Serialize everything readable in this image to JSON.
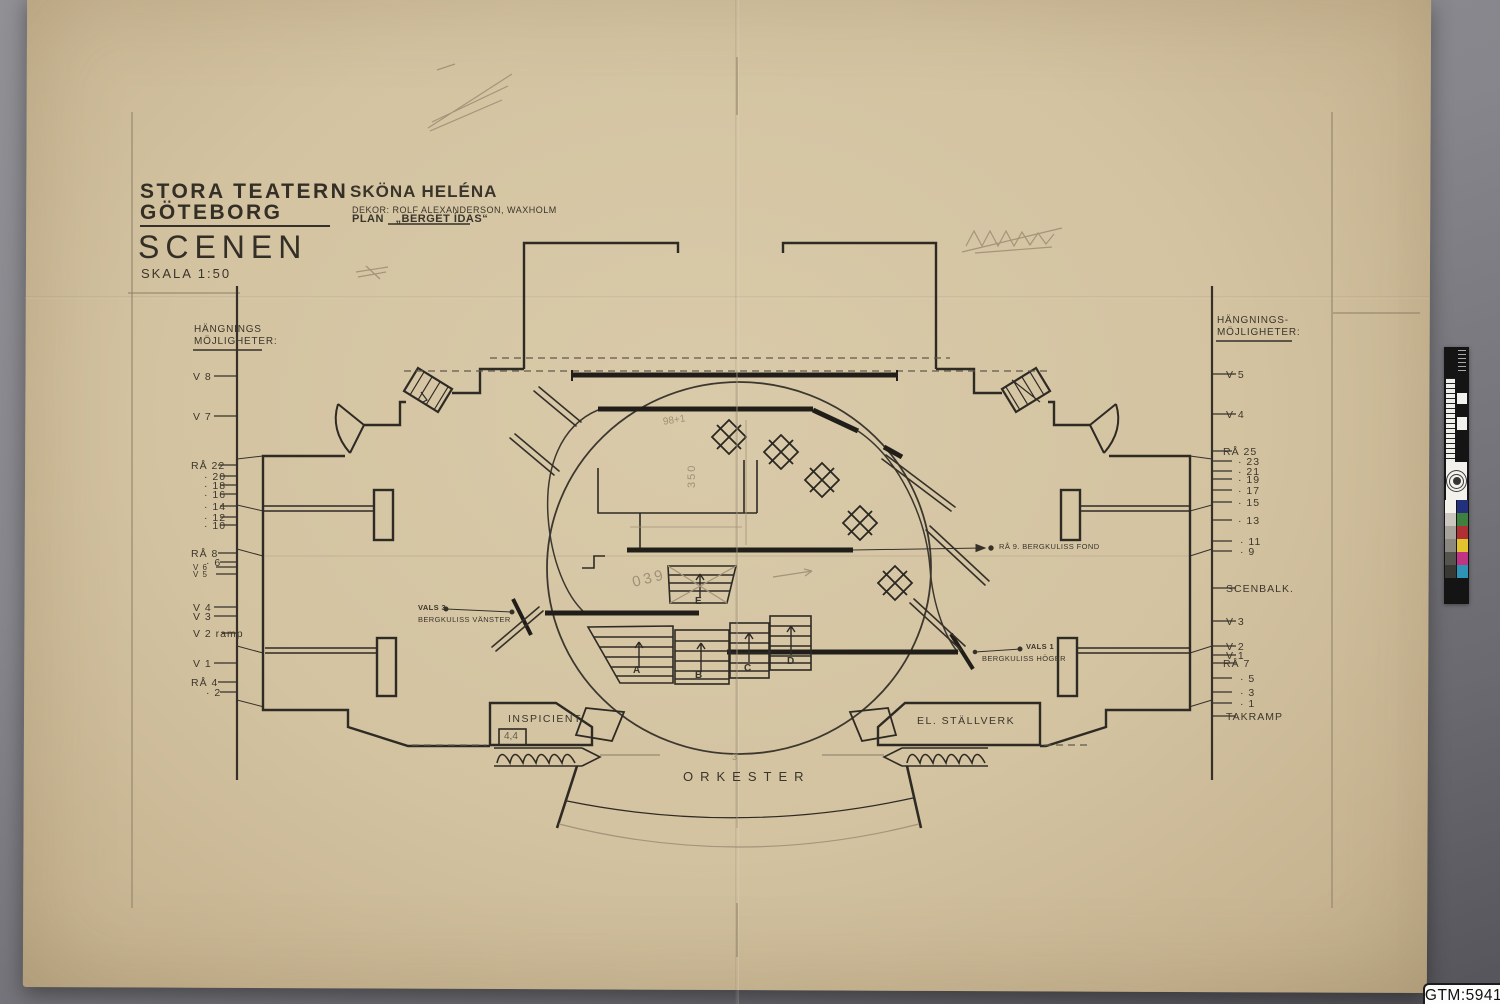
{
  "drawing": {
    "title_block": {
      "name1": "STORA TEATERN",
      "name2": "GÖTEBORG",
      "sheet": "SCENEN",
      "scale": "SKALA 1:50"
    },
    "production": {
      "title": "SKÖNA HELÉNA",
      "decor": "DEKOR: ROLF ALEXANDERSON, WAXHOLM",
      "plan_label": "PLAN",
      "plan_name": "„BERGET ÍDAS“"
    },
    "left_rigging": {
      "header1": "HÄNGNINGS",
      "header2": "MÖJLIGHETER:",
      "items": [
        "V 8",
        "V 7",
        "RÅ 22",
        "· 20",
        "· 18",
        "· 16",
        "· 14",
        "· 12",
        "· 10",
        "RÅ 8",
        "· 6",
        "V 6",
        "V 5",
        "V 4",
        "V 3",
        "V 2 ramp",
        "V 1",
        "RÅ 4",
        "· 2"
      ]
    },
    "right_rigging": {
      "header1": "HÄNGNINGS-",
      "header2": "MÖJLIGHETER:",
      "items": [
        "V 5",
        "V 4",
        "RÅ 25",
        "· 23",
        "· 21",
        "· 19",
        "· 17",
        "· 15",
        "· 13",
        "· 11",
        "· 9",
        "SCENBALK.",
        "V 3",
        "V 2",
        "V 1",
        "RÅ 7",
        "· 5",
        "· 3",
        "· 1",
        "TAKRAMP"
      ]
    },
    "annotations": {
      "fond": "RÅ 9. BERGKULISS FOND",
      "vals3": "VALS 3",
      "vals3_sub": "BERGKULISS VÄNSTER",
      "vals1": "VALS 1",
      "vals1_sub": "BERGKULISS HÖGER",
      "inspicient": "INSPICIENT",
      "stallverk": "EL. STÄLLVERK",
      "orkester": "ORKESTER"
    },
    "platforms": {
      "a": "A",
      "b": "B",
      "c": "C",
      "d": "D",
      "e": "E"
    },
    "pencil_notes": {
      "n1": "98+1",
      "n2": "350",
      "n3": "039",
      "n4": "4,4",
      "n5": "3"
    }
  },
  "archive": {
    "catalog_label": "GTM:5941"
  },
  "color_strip": {
    "gray_column": [
      "#f5f2ec",
      "#cbc7c0",
      "#a6a39d",
      "#8b8882",
      "#56544f",
      "#3a3833"
    ],
    "color_column": [
      "#23307c",
      "#3f8040",
      "#ae2f34",
      "#e2c42e",
      "#bf3583",
      "#2f93b5"
    ]
  }
}
